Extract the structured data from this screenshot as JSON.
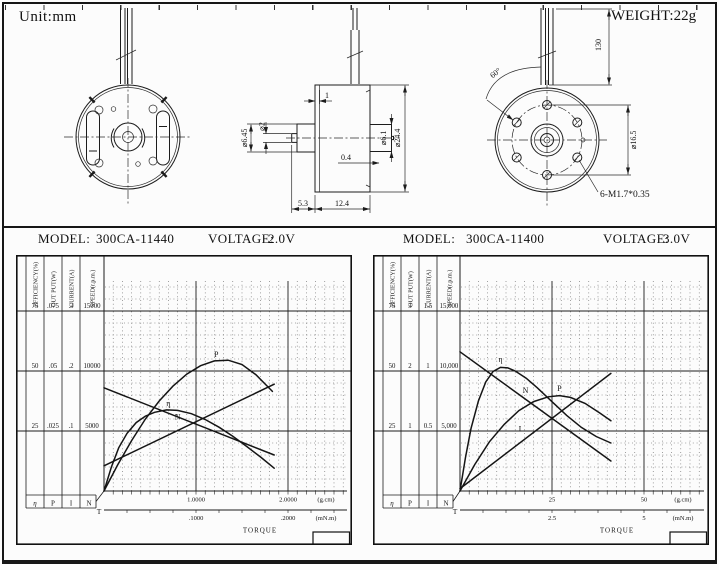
{
  "drawing": {
    "unit_label": "Unit:mm",
    "weight_label": "WEIGHT:22g",
    "views": [
      "front-view",
      "side-view",
      "rear-view"
    ],
    "side_view": {
      "dim_step": "1",
      "dim_shaft_dia": "⌀2",
      "dim_boss_dia": "⌀6.45",
      "dim_bearing_dia": "⌀6.1",
      "dim_body_dia": "⌀24.4",
      "dim_pin": "0.4",
      "dim_shaft_len": "5.3",
      "dim_body_len": "12.4"
    },
    "rear_view": {
      "dim_angle": "60°",
      "dim_wire_len": "130",
      "dim_bolt_circle": "⌀16.5",
      "dim_screws": "6-M1.7*0.35"
    }
  },
  "charts": [
    {
      "model_label": "MODEL:",
      "model": "300CA-11440",
      "voltage_label": "VOLTAGE:",
      "voltage": "2.0V",
      "scales": [
        {
          "title": "EFFICIENCY(%)",
          "values": [
            "75",
            "50",
            "25"
          ]
        },
        {
          "title": "OUT PUT(W)",
          "values": [
            ".075",
            ".05",
            ".025"
          ]
        },
        {
          "title": "CURRENT(A)",
          "values": [
            ".3",
            ".2",
            ".1"
          ]
        },
        {
          "title": "SPEED(r.p.m.)",
          "values": [
            "15000",
            "10000",
            "5000"
          ]
        }
      ],
      "legend_cells": [
        "η",
        "P",
        "I",
        "N"
      ],
      "origin_label": "T",
      "axis_gcm": {
        "labels": [
          "1.0000",
          "2.0000"
        ],
        "positions": [
          1,
          2
        ],
        "unit": "(g.cm)"
      },
      "axis_mnm": {
        "labels": [
          ".1000",
          ".2000"
        ],
        "positions": [
          1,
          2
        ],
        "unit": "(mN.m)"
      },
      "xlabel": "TORQUE"
    },
    {
      "model_label": "MODEL:",
      "model": "300CA-11400",
      "voltage_label": "VOLTAGE:",
      "voltage": "3.0V",
      "scales": [
        {
          "title": "EFFICIENCY(%)",
          "values": [
            "75",
            "50",
            "25"
          ]
        },
        {
          "title": "OUT PUT(W)",
          "values": [
            "3",
            "2",
            "1"
          ]
        },
        {
          "title": "CURRENT(A)",
          "values": [
            "1.5",
            "1",
            "0.5"
          ]
        },
        {
          "title": "SPEED(r.p.m.)",
          "values": [
            "15,000",
            "10,000",
            "5,000"
          ]
        }
      ],
      "legend_cells": [
        "η",
        "P",
        "I",
        "N"
      ],
      "origin_label": "T",
      "axis_gcm": {
        "labels": [
          "25",
          "50"
        ],
        "positions": [
          25,
          50
        ],
        "unit": "(g.cm)"
      },
      "axis_mnm": {
        "labels": [
          "2.5",
          "5"
        ],
        "positions": [
          25,
          50
        ],
        "unit": "(mN.m)"
      },
      "xlabel": "TORQUE"
    }
  ],
  "chart_data": [
    {
      "type": "line",
      "title": "300CA-11440 performance at 2.0V",
      "xlabel": "TORQUE",
      "x_unit": "g.cm",
      "x_range": [
        0,
        2.64
      ],
      "minor_step_gcm": 0.1,
      "grid": true,
      "y_axes": {
        "efficiency_pct": [
          0,
          87.5
        ],
        "output_w": [
          0,
          0.0875
        ],
        "current_a": [
          0,
          0.35
        ],
        "speed_rpm": [
          0,
          17500
        ]
      },
      "series": [
        {
          "name": "N",
          "label": "Speed (r.p.m.)",
          "quantity": "speed_rpm",
          "points": [
            [
              0,
              8600
            ],
            [
              1.85,
              3000
            ]
          ]
        },
        {
          "name": "I",
          "label": "Current (A)",
          "quantity": "current_a",
          "points": [
            [
              0,
              0.042
            ],
            [
              1.85,
              0.178
            ]
          ]
        },
        {
          "name": "P",
          "label": "Output (W)",
          "quantity": "output_w",
          "points": [
            [
              0,
              0
            ],
            [
              0.15,
              0.011
            ],
            [
              0.3,
              0.021
            ],
            [
              0.45,
              0.03
            ],
            [
              0.6,
              0.0375
            ],
            [
              0.75,
              0.0437
            ],
            [
              0.9,
              0.0487
            ],
            [
              1.05,
              0.0522
            ],
            [
              1.2,
              0.0542
            ],
            [
              1.35,
              0.0545
            ],
            [
              1.5,
              0.0527
            ],
            [
              1.65,
              0.0485
            ],
            [
              1.83,
              0.0415
            ]
          ]
        },
        {
          "name": "η",
          "label": "Efficiency (%)",
          "quantity": "efficiency_pct",
          "points": [
            [
              0,
              0
            ],
            [
              0.08,
              10
            ],
            [
              0.16,
              18
            ],
            [
              0.25,
              24
            ],
            [
              0.35,
              28.5
            ],
            [
              0.45,
              31.2
            ],
            [
              0.55,
              32.8
            ],
            [
              0.68,
              33.8
            ],
            [
              0.8,
              33.6
            ],
            [
              0.95,
              32.2
            ],
            [
              1.1,
              29.8
            ],
            [
              1.25,
              26.6
            ],
            [
              1.4,
              22.8
            ],
            [
              1.55,
              18.6
            ],
            [
              1.7,
              14.2
            ],
            [
              1.85,
              9.5
            ]
          ]
        }
      ],
      "curve_labels": [
        {
          "text": "P",
          "x": 1.22,
          "y_rpm": 11150
        },
        {
          "text": "η",
          "x": 0.7,
          "y_rpm": 7100
        },
        {
          "text": "N",
          "x": 0.8,
          "y_rpm": 5950
        }
      ]
    },
    {
      "type": "line",
      "title": "300CA-11400 performance at 3.0V",
      "xlabel": "TORQUE",
      "x_unit": "g.cm",
      "x_range": [
        0,
        66
      ],
      "minor_step_gcm": 2.5,
      "grid": true,
      "y_axes": {
        "efficiency_pct": [
          0,
          87.5
        ],
        "output_w": [
          0,
          3.5
        ],
        "current_a": [
          0,
          1.75
        ],
        "speed_rpm": [
          0,
          17500
        ]
      },
      "series": [
        {
          "name": "N",
          "label": "Speed (r.p.m.)",
          "quantity": "speed_rpm",
          "points": [
            [
              0,
              11600
            ],
            [
              41,
              2500
            ]
          ]
        },
        {
          "name": "I",
          "label": "Current (A)",
          "quantity": "current_a",
          "points": [
            [
              0,
              0.02
            ],
            [
              41,
              0.98
            ]
          ]
        },
        {
          "name": "P",
          "label": "Output (W)",
          "quantity": "output_w",
          "points": [
            [
              0,
              0
            ],
            [
              4,
              0.44
            ],
            [
              8,
              0.82
            ],
            [
              12,
              1.11
            ],
            [
              16,
              1.34
            ],
            [
              20,
              1.49
            ],
            [
              24,
              1.57
            ],
            [
              27,
              1.59
            ],
            [
              30,
              1.56
            ],
            [
              34,
              1.46
            ],
            [
              38,
              1.3
            ],
            [
              41,
              1.17
            ]
          ]
        },
        {
          "name": "η",
          "label": "Efficiency (%)",
          "quantity": "efficiency_pct",
          "points": [
            [
              0,
              0
            ],
            [
              1.5,
              14
            ],
            [
              3,
              26
            ],
            [
              5,
              37.5
            ],
            [
              7,
              45.5
            ],
            [
              9,
              49.8
            ],
            [
              11,
              51.5
            ],
            [
              13,
              51.3
            ],
            [
              15,
              50
            ],
            [
              18,
              47
            ],
            [
              21,
              43
            ],
            [
              25,
              37.2
            ],
            [
              29,
              31.5
            ],
            [
              33,
              26.5
            ],
            [
              37,
              22.7
            ],
            [
              41,
              20
            ]
          ]
        }
      ],
      "curve_labels": [
        {
          "text": "η",
          "x": 11,
          "y_rpm": 10750
        },
        {
          "text": "N",
          "x": 17.8,
          "y_rpm": 8150
        },
        {
          "text": "P",
          "x": 27,
          "y_rpm": 8350
        },
        {
          "text": "I",
          "x": 16.3,
          "y_rpm": 4950
        }
      ]
    }
  ]
}
